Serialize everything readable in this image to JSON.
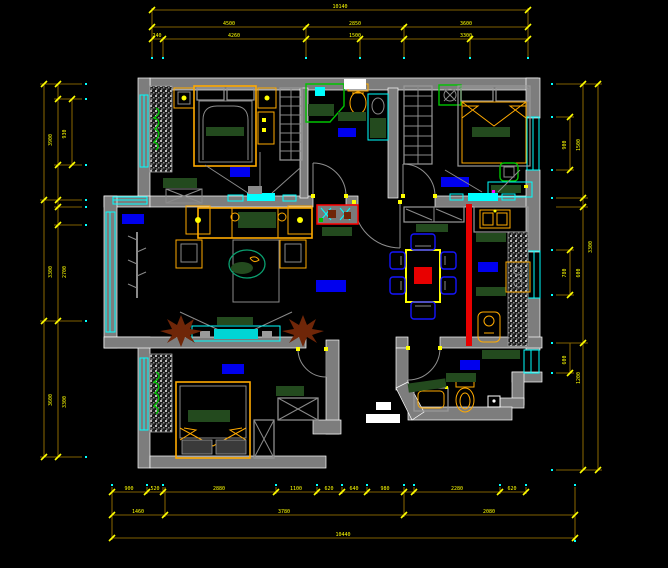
{
  "drawing": {
    "type": "cad-floor-plan",
    "background": "#000000"
  },
  "palette": {
    "wall": "#7d7d7d",
    "wall_outline": "#ffffff",
    "dimension_line": "#7f6000",
    "dimension_text": "#ffff00",
    "window": "#00ffff",
    "furniture_accent": "#ffaa00",
    "furniture_dark_green": "#234a1e",
    "room_label_block": "#0000ee",
    "slider_door": "#e80000",
    "fixture_green": "#00c400",
    "plant": "#6f2608",
    "chair_blue": "#1515ff"
  },
  "dims": {
    "top": {
      "row1": [
        "10140"
      ],
      "row2": [
        "4500",
        "2850",
        "3600"
      ],
      "row3": [
        "240",
        "4260",
        "1500",
        "3300"
      ]
    },
    "bottom": {
      "row1": [
        "900",
        "520",
        "2880",
        "1100",
        "620",
        "640",
        "980",
        "2280",
        "620"
      ],
      "row2": [
        "1460",
        "3780",
        "2080"
      ],
      "row3": [
        "10440"
      ]
    },
    "left": {
      "outer": [
        "3900",
        "3300",
        "3600"
      ],
      "inner": [
        "930",
        "2700",
        "3300"
      ]
    },
    "right": {
      "outer": [
        "3300"
      ],
      "inner": [
        "1500",
        "600",
        "1200"
      ],
      "short": [
        "900",
        "780",
        "600"
      ]
    }
  },
  "rooms": [
    {
      "id": "bedroom-top-left"
    },
    {
      "id": "bathroom-top"
    },
    {
      "id": "bedroom-top-right"
    },
    {
      "id": "living-room"
    },
    {
      "id": "dining-room"
    },
    {
      "id": "kitchen"
    },
    {
      "id": "bathroom-bottom"
    },
    {
      "id": "bedroom-bottom-left"
    },
    {
      "id": "hall"
    }
  ],
  "room_label_blocks": {
    "color": "#0000ee",
    "count": 8
  },
  "hall_markers": {
    "color": "#ffffff",
    "count": 2
  }
}
